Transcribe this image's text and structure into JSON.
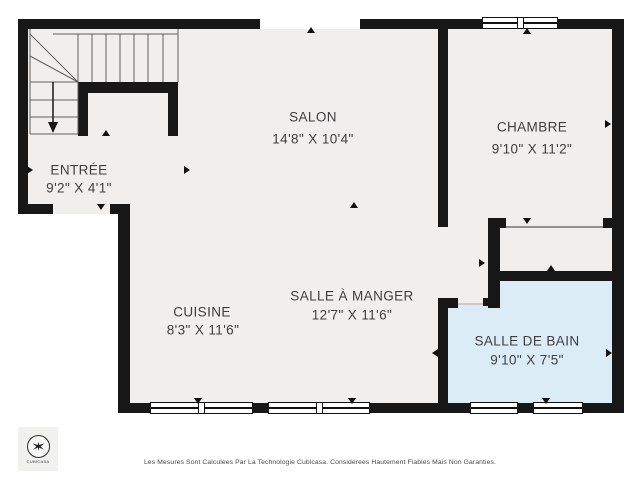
{
  "colors": {
    "wall": "#171717",
    "floor": "#f0efee",
    "bathroom_highlight": "#dbecf7",
    "label_text": "#3e3e3e"
  },
  "rooms": [
    {
      "id": "entree",
      "name": "ENTRÉE",
      "dims": "9'2\" X 4'1\""
    },
    {
      "id": "salon",
      "name": "SALON",
      "dims": "14'8\" X 10'4\""
    },
    {
      "id": "chambre",
      "name": "CHAMBRE",
      "dims": "9'10\" X 11'2\""
    },
    {
      "id": "cuisine",
      "name": "CUISINE",
      "dims": "8'3\" X 11'6\""
    },
    {
      "id": "salle_a_manger",
      "name": "SALLE À MANGER",
      "dims": "12'7\" X 11'6\""
    },
    {
      "id": "salle_de_bain",
      "name": "SALLE DE BAIN",
      "dims": "9'10\" X 7'5\""
    }
  ],
  "logo": {
    "label": "CUBICASA"
  },
  "footer": {
    "disclaimer": "Les Mesures Sont Calculees Par La Technologie Cubicasa. Considerees Hautement Fiables Mais Non Garanties."
  }
}
